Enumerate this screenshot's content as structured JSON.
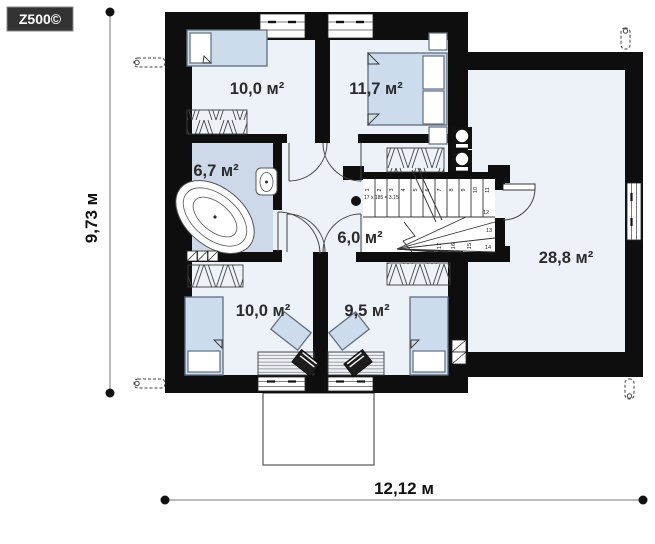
{
  "logo": {
    "text": "Z500©"
  },
  "dimensions": {
    "width_label": "12,12 м",
    "height_label": "9,73 м"
  },
  "rooms": [
    {
      "name": "bedroom-top-left",
      "area_label": "10,0 м²"
    },
    {
      "name": "bedroom-top-right",
      "area_label": "11,7 м²"
    },
    {
      "name": "bathroom",
      "area_label": "6,7 м²"
    },
    {
      "name": "hall",
      "area_label": "6,0 м²"
    },
    {
      "name": "bedroom-bottom-left",
      "area_label": "10,0 м²"
    },
    {
      "name": "bedroom-bottom-right",
      "area_label": "9,5 м²"
    },
    {
      "name": "attic-room",
      "area_label": "28,8 м²"
    }
  ],
  "stairs": {
    "annotation": "17 x 185 = 3.15",
    "steps": [
      "1",
      "2",
      "3",
      "4",
      "5",
      "6",
      "7",
      "8",
      "9",
      "10",
      "11",
      "12",
      "13",
      "14",
      "15",
      "16",
      "17"
    ]
  },
  "colors": {
    "wall": "#0e0e0e",
    "floor": "#edf2f9",
    "bath-floor": "#cdd9e8",
    "furniture": "#ccdcec",
    "furniture-border": "#5e6e7e",
    "line": "#333333"
  }
}
